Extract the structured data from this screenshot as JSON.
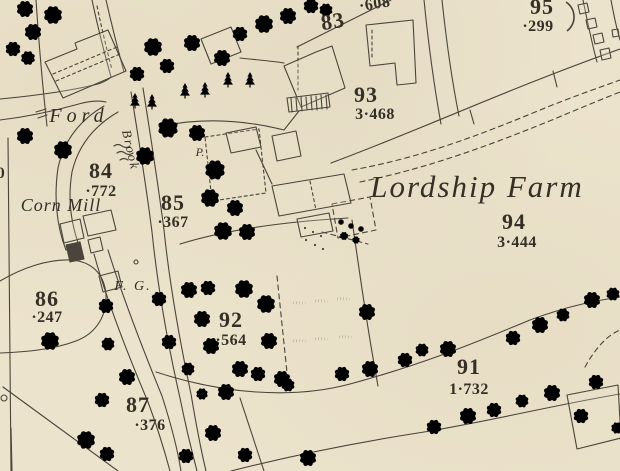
{
  "colors": {
    "paper": "#ece3cc",
    "ink": "#4a443a",
    "text": "#352f26"
  },
  "labels": {
    "ford": "Ford",
    "corn_mill": "Corn Mill",
    "lordship_farm": "Lordship Farm",
    "brook": "Brook",
    "field_gate": "F. G.",
    "pump": "P.",
    "edge_partial_number": "0"
  },
  "parcels": [
    {
      "number": "83",
      "acreage": "·608"
    },
    {
      "number": "93",
      "acreage": "3·468"
    },
    {
      "number": "95",
      "acreage": "·299"
    },
    {
      "number": "84",
      "acreage": "·772"
    },
    {
      "number": "85",
      "acreage": "·367"
    },
    {
      "number": "86",
      "acreage": "·247"
    },
    {
      "number": "92",
      "acreage": "·564"
    },
    {
      "number": "94",
      "acreage": "3·444"
    },
    {
      "number": "91",
      "acreage": "1·732"
    },
    {
      "number": "87",
      "acreage": "·376"
    }
  ]
}
